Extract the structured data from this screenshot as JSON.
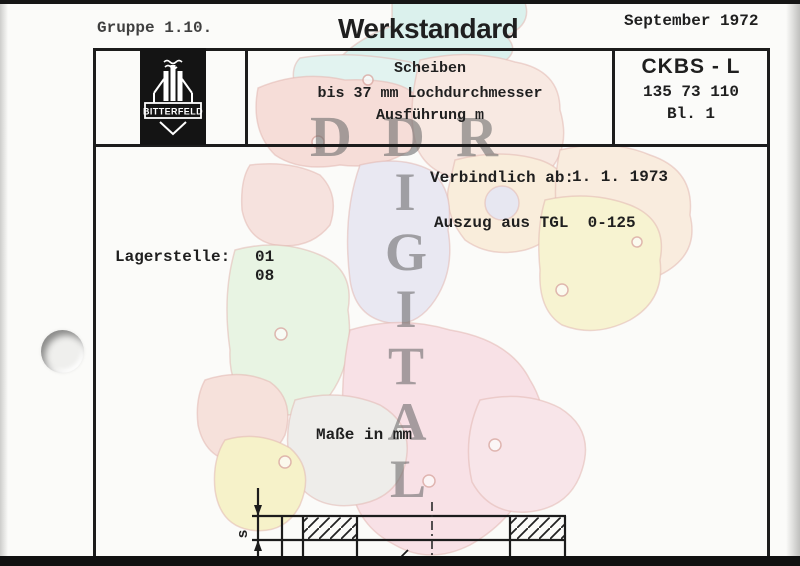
{
  "masthead": {
    "group": "Gruppe 1.10.",
    "title": "Werkstandard",
    "date": "September 1972"
  },
  "title_block": {
    "logo_text": "BITTERFELD",
    "subject": {
      "line1": "Scheiben",
      "line2": "bis 37 mm Lochdurchmesser",
      "line3": "Ausführung m"
    },
    "code": "CKBS - L",
    "number": "135 73 110",
    "sheet": "Bl. 1"
  },
  "body": {
    "valid_from_label": "Verbindlich ab:",
    "valid_from_value": "1. 1. 1973",
    "excerpt": "Auszug aus TGL  0-125",
    "storage_label": "Lagerstelle:",
    "storage_value1": "01",
    "storage_value2": "08",
    "units_note": "Maße in mm"
  },
  "drawing": {
    "thickness_label": "s"
  },
  "watermark": {
    "horizontal": [
      "D",
      "D",
      "R"
    ],
    "vertical": [
      "I",
      "G",
      "I",
      "T",
      "A",
      "L"
    ]
  },
  "colors": {
    "ink": "#1f1f1f",
    "watermark_gray": "#696969",
    "map_teal": "#c2e9e4",
    "map_red": "#f2c6be",
    "map_rose": "#f6dcd0",
    "map_peach": "#f8e0c8",
    "map_cream": "#f9e3c4",
    "map_lavender": "#dbd9ed",
    "map_mint": "#daf0d2",
    "map_yellow": "#f4eeb2",
    "map_pink": "#f7ccd8",
    "map_gray": "#e4e2df"
  }
}
